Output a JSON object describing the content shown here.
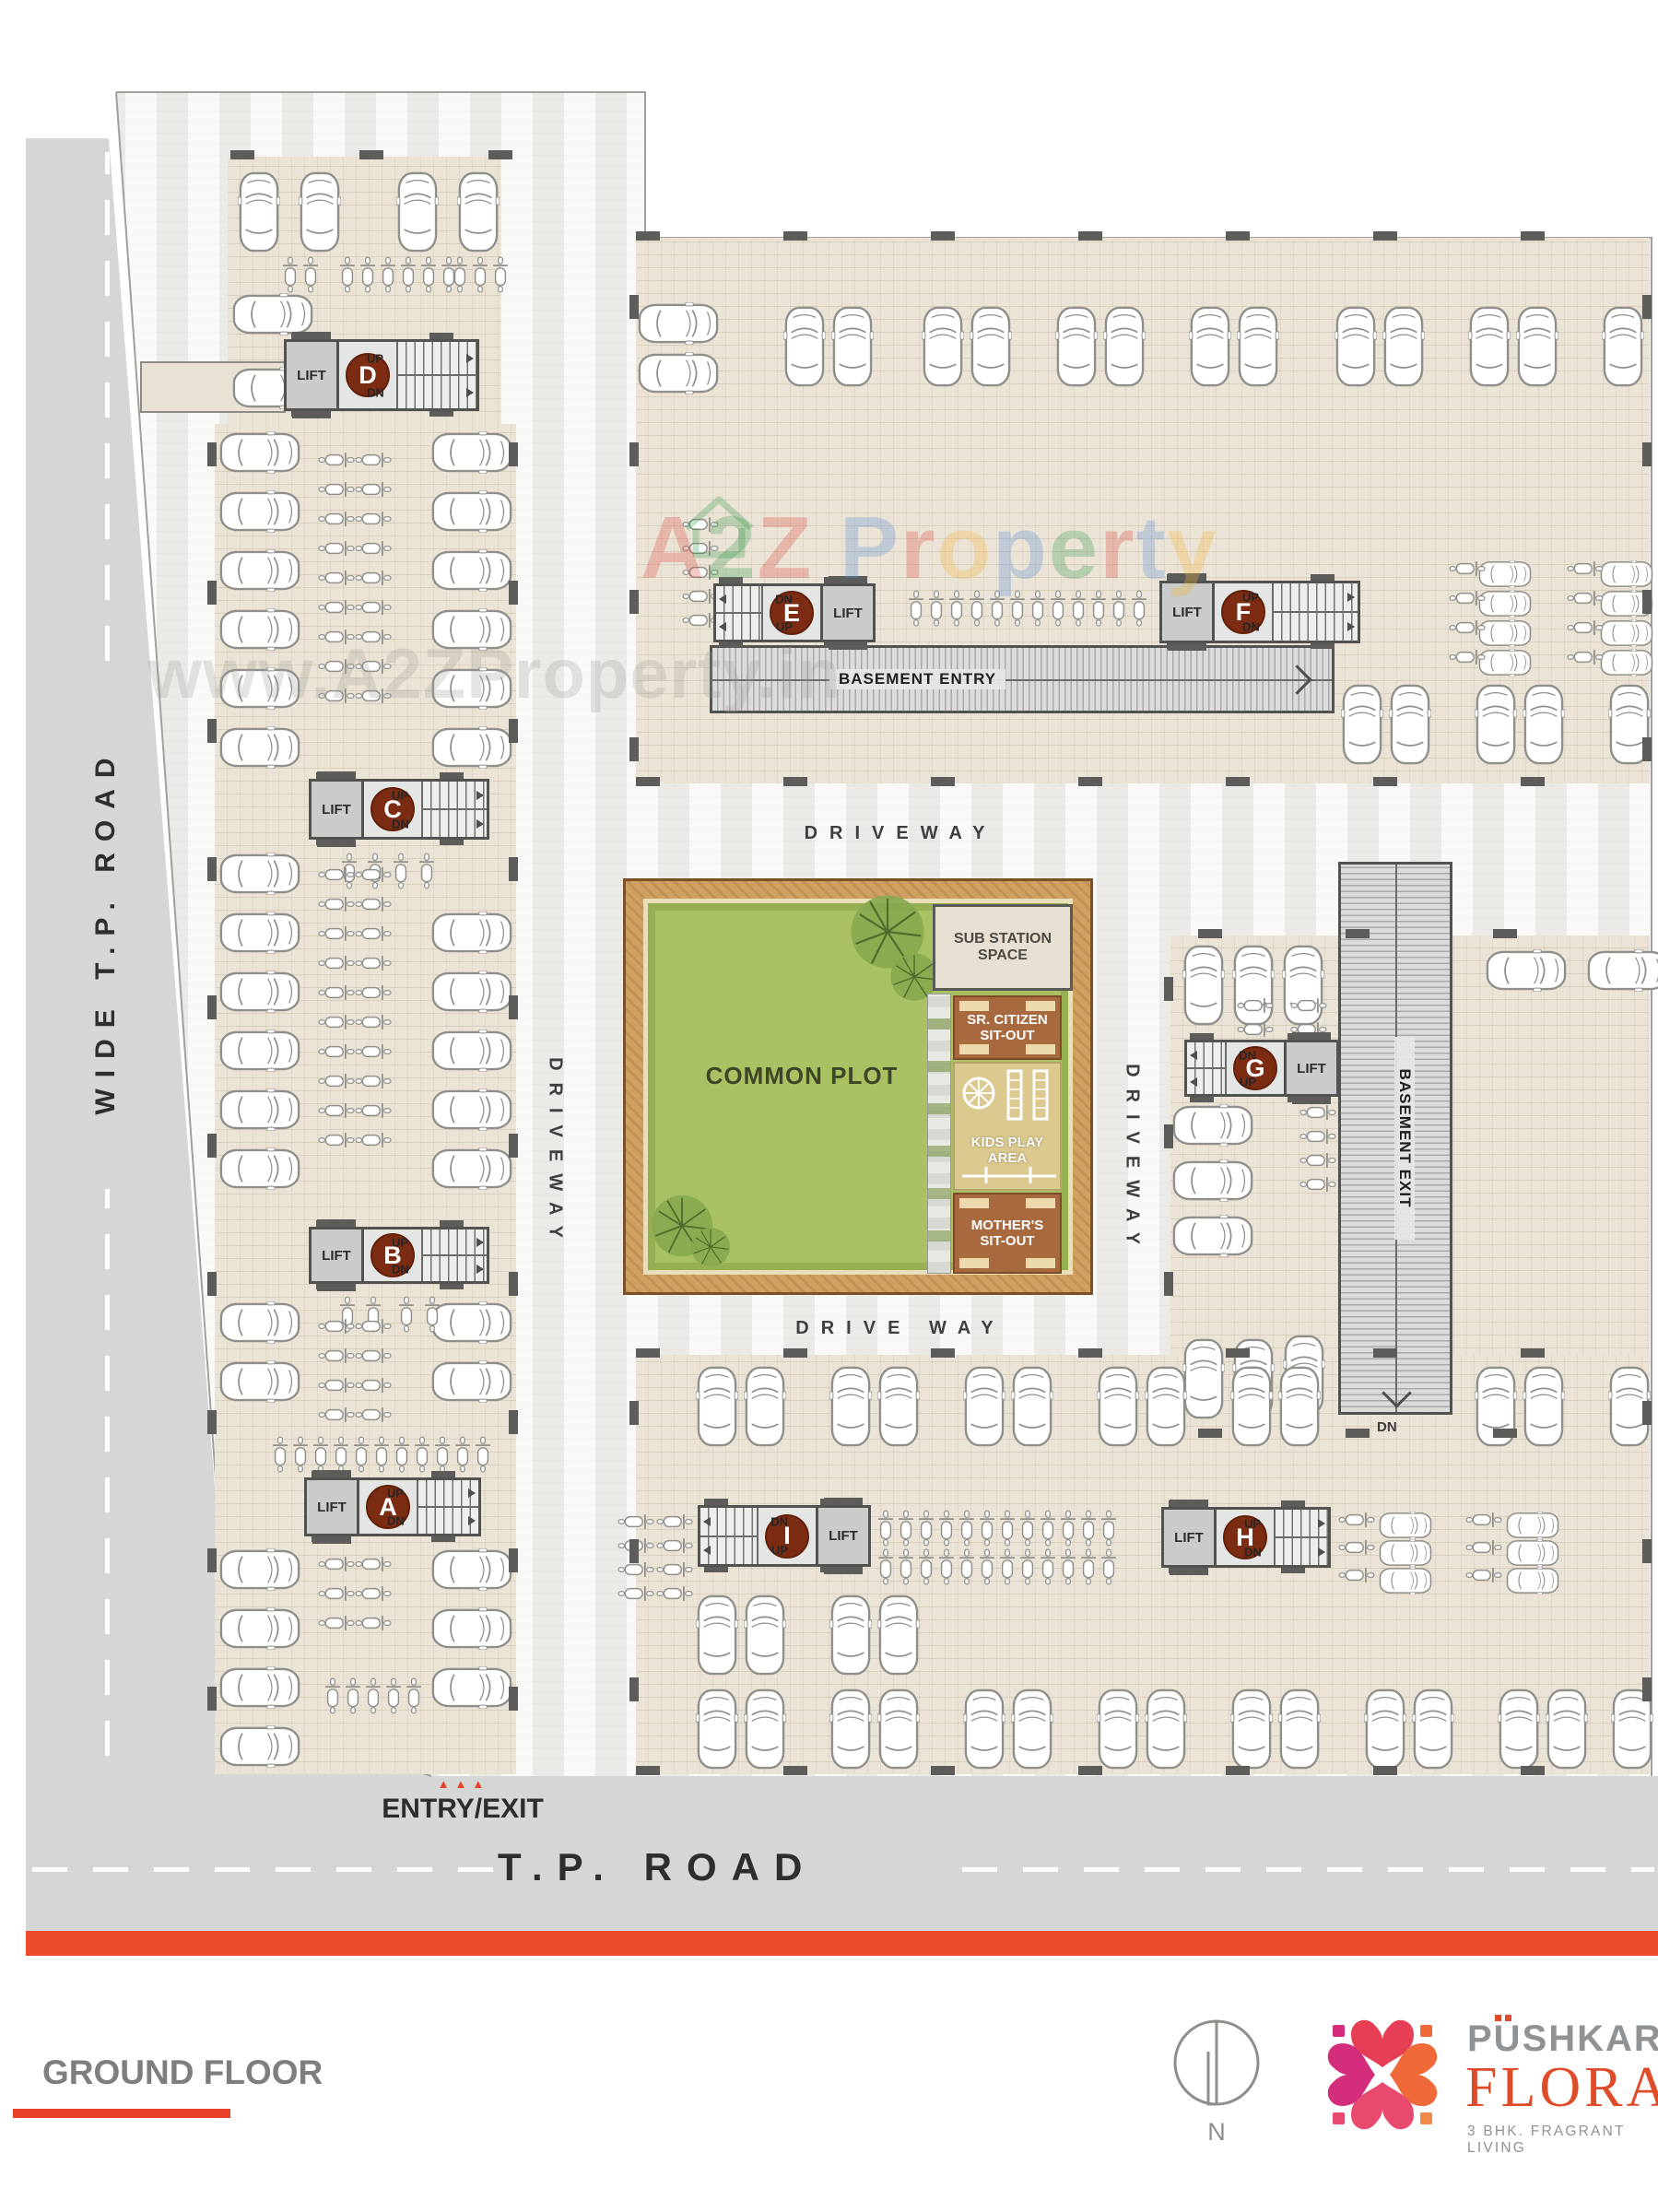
{
  "page": {
    "floor_label": "GROUND FLOOR"
  },
  "roads": {
    "left_vertical": "WIDE T.P. ROAD",
    "bottom": "T.P. ROAD",
    "entry_exit": "ENTRY/EXIT",
    "entry_arrows": "▲▲▲"
  },
  "driveways": {
    "top": "DRIVEWAY",
    "bottom": "DRIVE WAY",
    "left": "DRIVEWAY",
    "right": "DRIVEWAY"
  },
  "ramps": {
    "entry": "BASEMENT ENTRY",
    "exit": "BASEMENT EXIT",
    "exit_dn": "DN"
  },
  "amenities": {
    "common_plot": "COMMON PLOT",
    "sub_l1": "SUB STATION",
    "sub_l2": "SPACE",
    "sr_l1": "SR. CITIZEN",
    "sr_l2": "SIT-OUT",
    "kids_l1": "KIDS PLAY",
    "kids_l2": "AREA",
    "mom_l1": "MOTHER'S",
    "mom_l2": "SIT-OUT"
  },
  "cores": [
    {
      "label": "A",
      "lift": "LIFT",
      "top": "UP",
      "bottom": "DN"
    },
    {
      "label": "B",
      "lift": "LIFT",
      "top": "UP",
      "bottom": "DN"
    },
    {
      "label": "C",
      "lift": "LIFT",
      "top": "UP",
      "bottom": "DN"
    },
    {
      "label": "D",
      "lift": "LIFT",
      "top": "UP",
      "bottom": "DN"
    },
    {
      "label": "E",
      "lift": "LIFT",
      "top": "DN",
      "bottom": "UP"
    },
    {
      "label": "F",
      "lift": "LIFT",
      "top": "UP",
      "bottom": "DN"
    },
    {
      "label": "G",
      "lift": "LIFT",
      "top": "DN",
      "bottom": "UP"
    },
    {
      "label": "H",
      "lift": "LIFT",
      "top": "UP",
      "bottom": "DN"
    },
    {
      "label": "I",
      "lift": "LIFT",
      "top": "DN",
      "bottom": "UP"
    }
  ],
  "watermark": {
    "url": "www.A2ZProperty.in",
    "letters": [
      {
        "ch": "A",
        "c": "#d94f43"
      },
      {
        "ch": "2",
        "c": "#3f9e52"
      },
      {
        "ch": "Z",
        "c": "#d94f43"
      },
      {
        "ch": " ",
        "c": "#000000"
      },
      {
        "ch": "P",
        "c": "#5b8fd6"
      },
      {
        "ch": "r",
        "c": "#d94f43"
      },
      {
        "ch": "o",
        "c": "#f2b63c"
      },
      {
        "ch": "p",
        "c": "#5b8fd6"
      },
      {
        "ch": "e",
        "c": "#3f9e52"
      },
      {
        "ch": "r",
        "c": "#d94f43"
      },
      {
        "ch": "t",
        "c": "#5b8fd6"
      },
      {
        "ch": "y",
        "c": "#f2b63c"
      }
    ]
  },
  "branding": {
    "north": "N",
    "name_top": "PUSHKAR",
    "name_main": "FLORA",
    "tagline": "3 BHK. FRAGRANT LIVING"
  },
  "colors": {
    "accent_red": "#e8432a",
    "badge_brown": "#7b2c12",
    "lawn_green": "#a9c163",
    "band_tan": "#cfa05f",
    "road_grey": "#d5d7d6",
    "slab_beige": "#ebe4d6"
  },
  "decorations": {
    "cars_v": [
      [
        258,
        186,
        2,
        66
      ],
      [
        430,
        186,
        2,
        66
      ],
      [
        850,
        332,
        2,
        52
      ],
      [
        1000,
        332,
        2,
        52
      ],
      [
        1145,
        332,
        2,
        52
      ],
      [
        1290,
        332,
        2,
        52
      ],
      [
        1448,
        332,
        2,
        52
      ],
      [
        1593,
        332,
        2,
        52
      ],
      [
        1738,
        332,
        1,
        52
      ],
      [
        1455,
        742,
        2,
        52
      ],
      [
        1600,
        742,
        2,
        52
      ],
      [
        1745,
        742,
        1,
        52
      ],
      [
        1283,
        1025,
        3,
        54
      ],
      [
        1283,
        1452,
        2,
        54
      ],
      [
        1392,
        1448,
        1,
        54
      ],
      [
        755,
        1482,
        2,
        52
      ],
      [
        900,
        1482,
        2,
        52
      ],
      [
        1045,
        1482,
        2,
        52
      ],
      [
        1190,
        1482,
        2,
        52
      ],
      [
        1335,
        1482,
        2,
        52
      ],
      [
        1600,
        1482,
        2,
        52
      ],
      [
        1745,
        1482,
        1,
        52
      ],
      [
        755,
        1730,
        2,
        52
      ],
      [
        900,
        1730,
        2,
        52
      ],
      [
        755,
        1832,
        2,
        52
      ],
      [
        900,
        1832,
        2,
        52
      ],
      [
        1045,
        1832,
        2,
        52
      ],
      [
        1190,
        1832,
        2,
        52
      ],
      [
        1335,
        1832,
        2,
        52
      ],
      [
        1480,
        1832,
        2,
        52
      ],
      [
        1625,
        1832,
        2,
        52
      ],
      [
        1748,
        1832,
        1,
        52
      ]
    ],
    "cars_h": [
      [
        238,
        468,
        6,
        64
      ],
      [
        468,
        468,
        6,
        64
      ],
      [
        238,
        925,
        6,
        64
      ],
      [
        468,
        989,
        5,
        64
      ],
      [
        238,
        1412,
        2,
        64
      ],
      [
        468,
        1412,
        2,
        64
      ],
      [
        238,
        1680,
        4,
        64
      ],
      [
        468,
        1680,
        3,
        64
      ],
      [
        252,
        318,
        1,
        0
      ],
      [
        252,
        398,
        1,
        0
      ],
      [
        692,
        328,
        2,
        54
      ],
      [
        1272,
        1198,
        3,
        60
      ],
      [
        1612,
        1030,
        1,
        0
      ],
      [
        1722,
        1030,
        1,
        0
      ]
    ],
    "cars_h_small": [
      [
        1602,
        608,
        4,
        32
      ],
      [
        1734,
        608,
        4,
        32
      ],
      [
        1494,
        1640,
        3,
        30
      ],
      [
        1632,
        1640,
        3,
        30
      ]
    ],
    "bikes_v": [
      [
        306,
        278,
        2,
        22
      ],
      [
        368,
        278,
        6,
        22
      ],
      [
        490,
        278,
        3,
        22
      ],
      [
        985,
        640,
        12,
        22
      ],
      [
        295,
        1558,
        11,
        22
      ],
      [
        368,
        1406,
        2,
        28
      ],
      [
        432,
        1406,
        2,
        28
      ],
      [
        370,
        925,
        4,
        28
      ],
      [
        952,
        1638,
        12,
        22
      ],
      [
        952,
        1680,
        12,
        22
      ],
      [
        352,
        1820,
        5,
        22
      ]
    ],
    "bikes_h": [
      [
        740,
        560,
        5,
        26
      ],
      [
        1572,
        608,
        4,
        32
      ],
      [
        1700,
        608,
        4,
        32
      ],
      [
        1410,
        1198,
        4,
        26
      ],
      [
        1342,
        1082,
        2,
        26
      ],
      [
        1400,
        1082,
        2,
        26
      ],
      [
        670,
        1642,
        4,
        26
      ],
      [
        712,
        1642,
        4,
        26
      ],
      [
        1452,
        1640,
        3,
        30
      ],
      [
        1590,
        1640,
        3,
        30
      ],
      [
        345,
        490,
        9,
        32
      ],
      [
        385,
        490,
        9,
        32
      ],
      [
        345,
        940,
        10,
        32
      ],
      [
        385,
        940,
        10,
        32
      ],
      [
        345,
        1430,
        4,
        32
      ],
      [
        385,
        1430,
        4,
        32
      ],
      [
        345,
        1688,
        3,
        32
      ],
      [
        385,
        1688,
        3,
        32
      ]
    ],
    "ticks": [
      [
        250,
        163,
        3,
        140,
        0,
        26,
        10
      ],
      [
        690,
        251,
        7,
        160,
        0,
        26,
        10
      ],
      [
        690,
        843,
        7,
        160,
        0,
        26,
        10
      ],
      [
        690,
        1463,
        7,
        160,
        0,
        26,
        10
      ],
      [
        690,
        1916,
        7,
        160,
        0,
        26,
        10
      ],
      [
        1300,
        1008,
        3,
        160,
        0,
        26,
        10
      ],
      [
        1300,
        1550,
        3,
        160,
        0,
        26,
        10
      ],
      [
        225,
        480,
        10,
        0,
        150,
        10,
        26
      ],
      [
        552,
        480,
        10,
        0,
        150,
        10,
        26
      ],
      [
        683,
        320,
        4,
        0,
        160,
        10,
        26
      ],
      [
        1782,
        320,
        4,
        0,
        160,
        10,
        26
      ],
      [
        1263,
        1060,
        3,
        0,
        160,
        10,
        26
      ],
      [
        683,
        1520,
        3,
        0,
        150,
        10,
        26
      ],
      [
        1782,
        1520,
        3,
        0,
        150,
        10,
        26
      ],
      [
        338,
        1596,
        2,
        130,
        0,
        26,
        10
      ],
      [
        338,
        1663,
        2,
        130,
        0,
        26,
        10
      ],
      [
        343,
        1324,
        2,
        134,
        0,
        26,
        10
      ],
      [
        343,
        1389,
        2,
        134,
        0,
        26,
        10
      ],
      [
        343,
        838,
        2,
        134,
        0,
        26,
        10
      ],
      [
        343,
        907,
        2,
        134,
        0,
        26,
        10
      ],
      [
        316,
        361,
        2,
        150,
        0,
        26,
        10
      ],
      [
        316,
        442,
        2,
        150,
        0,
        26,
        10
      ],
      [
        780,
        626,
        2,
        114,
        0,
        26,
        10
      ],
      [
        780,
        693,
        2,
        114,
        0,
        26,
        10
      ],
      [
        1266,
        623,
        2,
        156,
        0,
        26,
        10
      ],
      [
        1266,
        694,
        2,
        156,
        0,
        26,
        10
      ],
      [
        1291,
        1121,
        2,
        106,
        0,
        26,
        10
      ],
      [
        1291,
        1186,
        2,
        106,
        0,
        26,
        10
      ],
      [
        1268,
        1628,
        2,
        122,
        0,
        26,
        10
      ],
      [
        1268,
        1697,
        2,
        122,
        0,
        26,
        10
      ],
      [
        764,
        1626,
        2,
        126,
        0,
        26,
        10
      ],
      [
        764,
        1696,
        2,
        126,
        0,
        26,
        10
      ]
    ],
    "trees": [
      [
        920,
        968,
        86
      ],
      [
        964,
        1032,
        56
      ],
      [
        704,
        1294,
        72
      ],
      [
        748,
        1330,
        46
      ]
    ]
  }
}
